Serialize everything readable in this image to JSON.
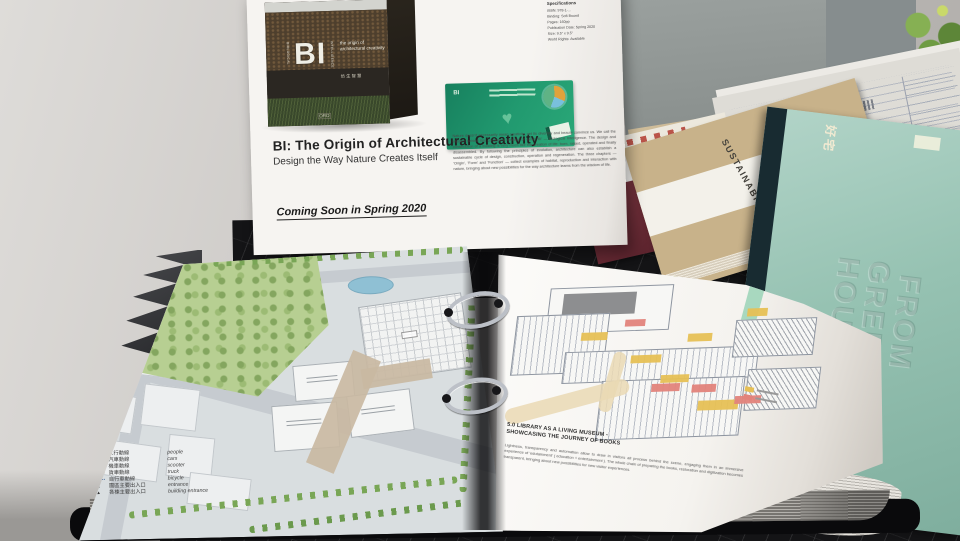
{
  "poster": {
    "title": "BI: The Origin of Architectural Creativity",
    "subtitle": "Design the Way Nature Creates Itself",
    "coming_soon": "Coming Soon in Spring 2020",
    "specs": {
      "heading": "Specifications",
      "lines": [
        "ISBN: 978-1-…",
        "Binding: Soft Bound",
        "Pages: 160pp",
        "Publication Date: Spring 2020",
        "Size: 9.5\" x 9.5\"",
        "World Rights: Available"
      ]
    },
    "blurb": "Nature doesn't necessarily mean creativity, yet its diversity and beauty convince us. We call the wisdom behind this consistent creation of value 'BI' — Biological Intelligence. The design and construction of a building is very much like the creation of life: born, raised, operated and finally disassembled. By following the principles of evolution, architecture can also establish a sustainable cycle of design, construction, operation and regeneration. The three chapters — 'Origin', 'Form' and 'Function' — collect examples of habitat, reproduction and interaction with nature, bringing about new possibilities for the way architecture learns from the wisdom of life.",
    "book_cover": {
      "series_left": "BIOLOGICAL",
      "series_right": "INTELLIGENCE",
      "monogram": "BI",
      "tagline": "the origin of architectural creativity",
      "cjk": "仿生智慧",
      "publisher": "ORO"
    },
    "green_card_colors": [
      "#e0a23c",
      "#79c0dd",
      "#5fb385",
      "#1f8f66"
    ]
  },
  "site_plan": {
    "legend": {
      "heading": "圖例",
      "north": "N",
      "items": [
        {
          "zh": "人行動線",
          "en": "people"
        },
        {
          "zh": "汽車動線",
          "en": "cars"
        },
        {
          "zh": "機車動線",
          "en": "scooter"
        },
        {
          "zh": "貨車動線",
          "en": "truck"
        },
        {
          "zh": "自行車動線",
          "en": "bicycle"
        },
        {
          "zh": "園區主要出入口",
          "en": "entrance"
        },
        {
          "zh": "各棟主要出入口",
          "en": "building entrance"
        }
      ]
    }
  },
  "right_page": {
    "heading_line1": "5.0 LIBRARY AS A LIVING MUSEUM -",
    "heading_line2": "SHOWCASING THE JOURNEY OF BOOKS",
    "body": "Lightness, transparency and automation allow to draw in visitors all process behind the scene, engaging them in an immersive experience of 'edutainment' ( education + entertainment ). The whole chain of preparing the books, restoration and digitization becomes transparent, bringing about new possibilities for new visitor experiences.",
    "route_legend_colors": [
      "#e6bf55",
      "#e2837b"
    ],
    "tab_color": "#a8d8bf"
  },
  "books": {
    "band_text": "SUSTAINABILITY",
    "teal_embossed": [
      "FROM",
      "GREEN",
      "HOUSE"
    ],
    "teal_top_label": "好宅"
  }
}
